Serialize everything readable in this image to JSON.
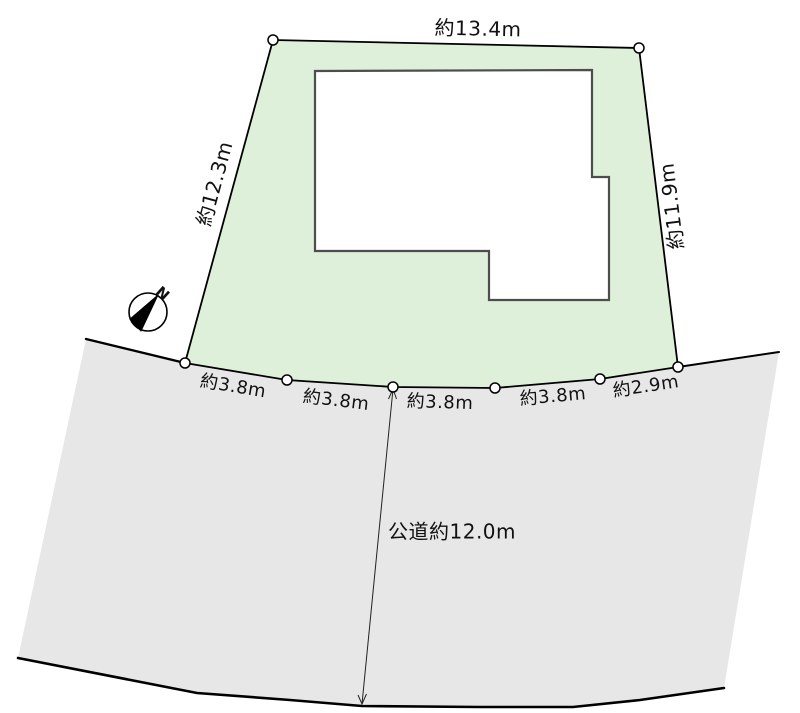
{
  "site_plan": {
    "compass": {
      "north_label": "N"
    },
    "dimensions": {
      "top_edge": "約13.4m",
      "left_edge": "約12.3m",
      "right_edge": "約11.9m",
      "frontage": [
        "約3.8m",
        "約3.8m",
        "約3.8m",
        "約3.8m",
        "約2.9m"
      ],
      "road": "公道約12.0m"
    },
    "colors": {
      "lot_fill": "#dff0da",
      "road_fill": "#e7e7e7",
      "building_fill": "#ffffff",
      "building_stroke": "#4d4d4d",
      "outline": "#000000"
    }
  }
}
